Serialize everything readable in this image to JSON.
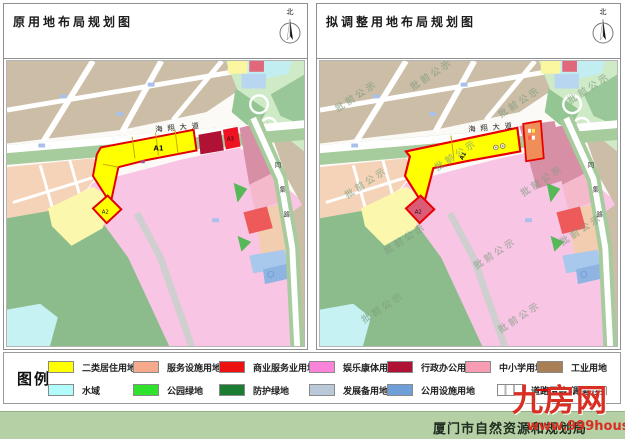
{
  "panels": {
    "left": {
      "title": "原用地布局规划图"
    },
    "right": {
      "title": "拟调整用地布局规划图"
    },
    "north_label": "北"
  },
  "map": {
    "avenue_label": "海翔大道",
    "east_road_chars": [
      "同",
      "集",
      "路"
    ],
    "plots": {
      "a1": "A1",
      "a2": "A2",
      "a3": "A3"
    },
    "watermark": "批前公示"
  },
  "legend": {
    "title": "图例",
    "row1": [
      {
        "label": "二类居住用地",
        "color": "#ffff00"
      },
      {
        "label": "服务设施用地",
        "color": "#f6a98c"
      },
      {
        "label": "商业服务业用地",
        "color": "#ee1111"
      },
      {
        "label": "娱乐康体用地",
        "color": "#fb84da"
      },
      {
        "label": "行政办公用地",
        "color": "#b01236"
      },
      {
        "label": "中小学用地",
        "color": "#f79cb2"
      },
      {
        "label": "工业用地",
        "color": "#a97f55"
      }
    ],
    "row2": [
      {
        "label": "水域",
        "color": "#b2fbfb"
      },
      {
        "label": "公园绿地",
        "color": "#2ee22e"
      },
      {
        "label": "防护绿地",
        "color": "#1a7d32"
      },
      {
        "label": "发展备用地",
        "color": "#bac9d9"
      },
      {
        "label": "公用设施用地",
        "color": "#6f9fd8"
      },
      {
        "label": "道路用地",
        "color": "#ffffff"
      },
      {
        "label": "调整范围",
        "color": "#dd0000"
      }
    ]
  },
  "footer": {
    "agency": "厦门市自然资源和规划局"
  },
  "brand": {
    "name": "九房网",
    "url": "www.999house.com"
  }
}
